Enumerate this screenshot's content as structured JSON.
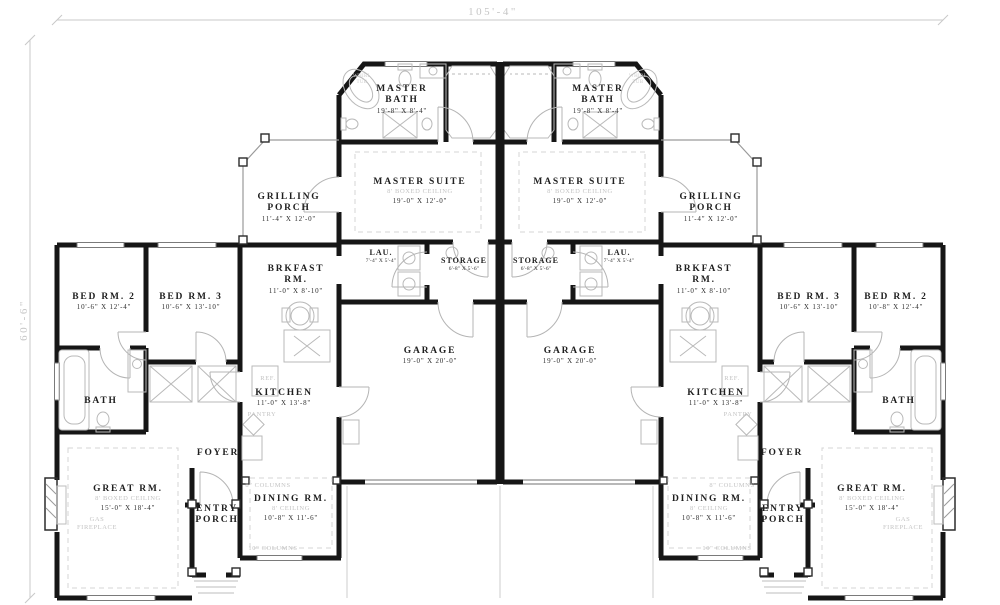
{
  "dims": {
    "overall_width": "105'-4\"",
    "overall_height": "60'-6\""
  },
  "colors": {
    "wall": "#161616",
    "faint_text": "#c4c4c4",
    "dimension_text": "#c6c6c6",
    "background": "#ffffff"
  },
  "rooms": {
    "master_bath": {
      "l1": "MASTER",
      "l2": "BATH",
      "size": "19'-8\" X 8'-4\""
    },
    "master_suite": {
      "l1": "MASTER SUITE",
      "note": "8' BOXED CEILING",
      "size": "19'-0\" X 12'-0\""
    },
    "grilling_porch": {
      "l1": "GRILLING",
      "l2": "PORCH",
      "size": "11'-4\" X 12'-0\""
    },
    "laundry": {
      "l1": "LAU.",
      "size": "7'-4\" X 5'-4\""
    },
    "storage": {
      "l1": "STORAGE",
      "size": "6'-8\" X 5'-6\""
    },
    "brkfast": {
      "l1": "BRKFAST",
      "l2": "RM.",
      "size": "11'-0\" X 8'-10\""
    },
    "bed2_left": {
      "l1": "BED RM. 2",
      "size": "10'-6\" X 12'-4\""
    },
    "bed2_right": {
      "l1": "BED RM. 2",
      "size": "10'-8\" X 12'-4\""
    },
    "bed3": {
      "l1": "BED RM. 3",
      "size": "10'-6\" X 13'-10\""
    },
    "bath": {
      "l1": "BATH"
    },
    "kitchen": {
      "l1": "KITCHEN",
      "size": "11'-0\" X 13'-8\""
    },
    "pantry": {
      "l1": "PANTRY"
    },
    "fridge": {
      "l1": "REF."
    },
    "foyer": {
      "l1": "FOYER"
    },
    "garage": {
      "l1": "GARAGE",
      "size": "19'-0\" X 20'-0\""
    },
    "great_rm": {
      "l1": "GREAT RM.",
      "note": "8' BOXED CEILING",
      "size": "15'-0\" X 18'-4\""
    },
    "gas_fireplace": {
      "l1": "GAS",
      "l2": "FIREPLACE"
    },
    "entry_porch": {
      "l1": "ENTRY",
      "l2": "PORCH"
    },
    "dining": {
      "l1": "DINING RM.",
      "note": "8' CEILING",
      "size": "10'-8\" X 11'-6\""
    },
    "whirl_tub": {
      "l1": "WHIRL",
      "l2": "TUB"
    },
    "columns_8": {
      "l1": "8\" COLUMNS"
    },
    "columns_10": {
      "l1": "10\" COLUMNS"
    }
  }
}
